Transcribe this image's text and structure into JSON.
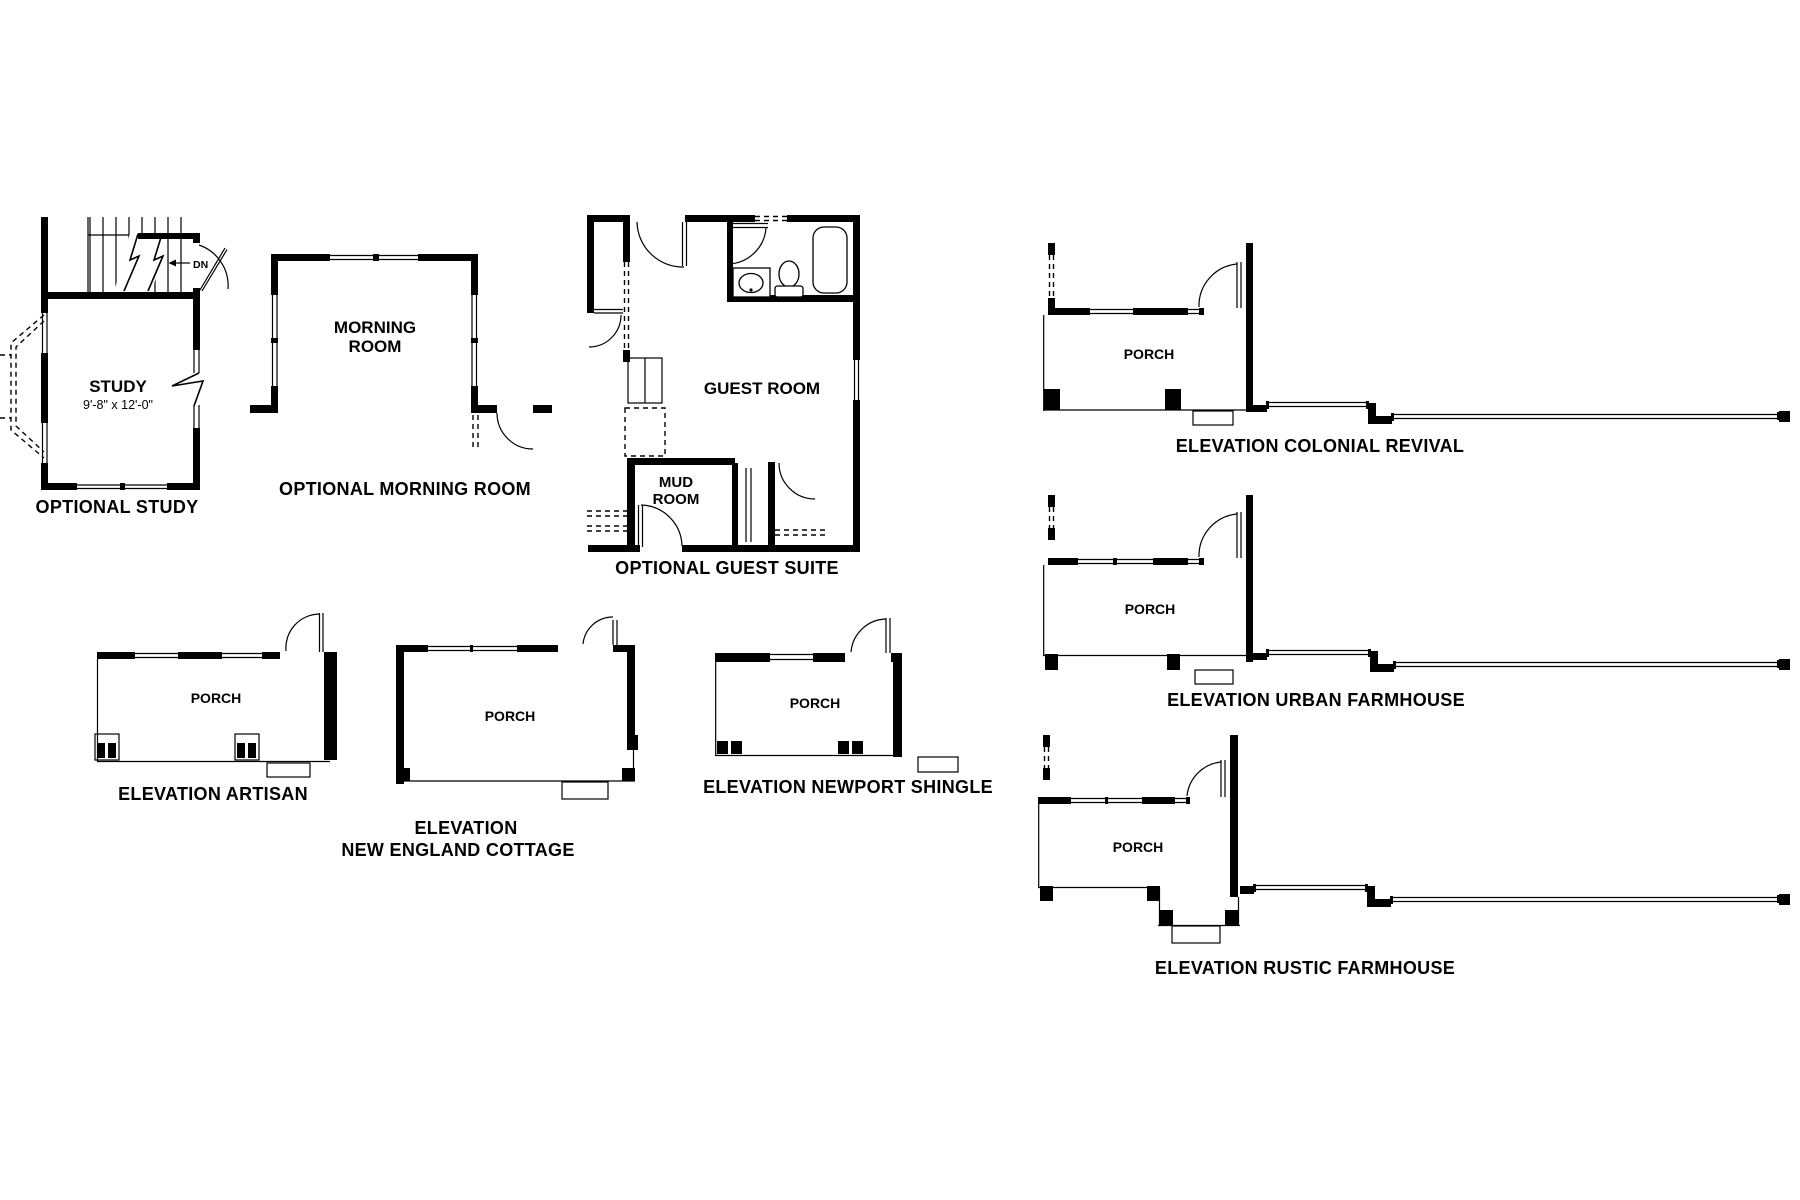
{
  "colors": {
    "ink": "#000000",
    "paper": "#ffffff"
  },
  "plans": {
    "study": {
      "caption": "OPTIONAL STUDY",
      "room_label": "STUDY",
      "room_dimensions": "9'-8\" x 12'-0\"",
      "stair_direction": "DN"
    },
    "morning_room": {
      "caption": "OPTIONAL MORNING ROOM",
      "room_label_line1": "MORNING",
      "room_label_line2": "ROOM"
    },
    "guest_suite": {
      "caption": "OPTIONAL GUEST SUITE",
      "guest_room_label": "GUEST ROOM",
      "mud_room_label_line1": "MUD",
      "mud_room_label_line2": "ROOM"
    }
  },
  "elevations": {
    "artisan": {
      "caption": "ELEVATION ARTISAN",
      "porch_label": "PORCH"
    },
    "new_england_cottage": {
      "caption_line1": "ELEVATION",
      "caption_line2": "NEW ENGLAND COTTAGE",
      "porch_label": "PORCH"
    },
    "newport_shingle": {
      "caption": "ELEVATION NEWPORT SHINGLE",
      "porch_label": "PORCH"
    },
    "colonial_revival": {
      "caption": "ELEVATION COLONIAL REVIVAL",
      "porch_label": "PORCH"
    },
    "urban_farmhouse": {
      "caption": "ELEVATION URBAN FARMHOUSE",
      "porch_label": "PORCH"
    },
    "rustic_farmhouse": {
      "caption": "ELEVATION RUSTIC FARMHOUSE",
      "porch_label": "PORCH"
    }
  }
}
